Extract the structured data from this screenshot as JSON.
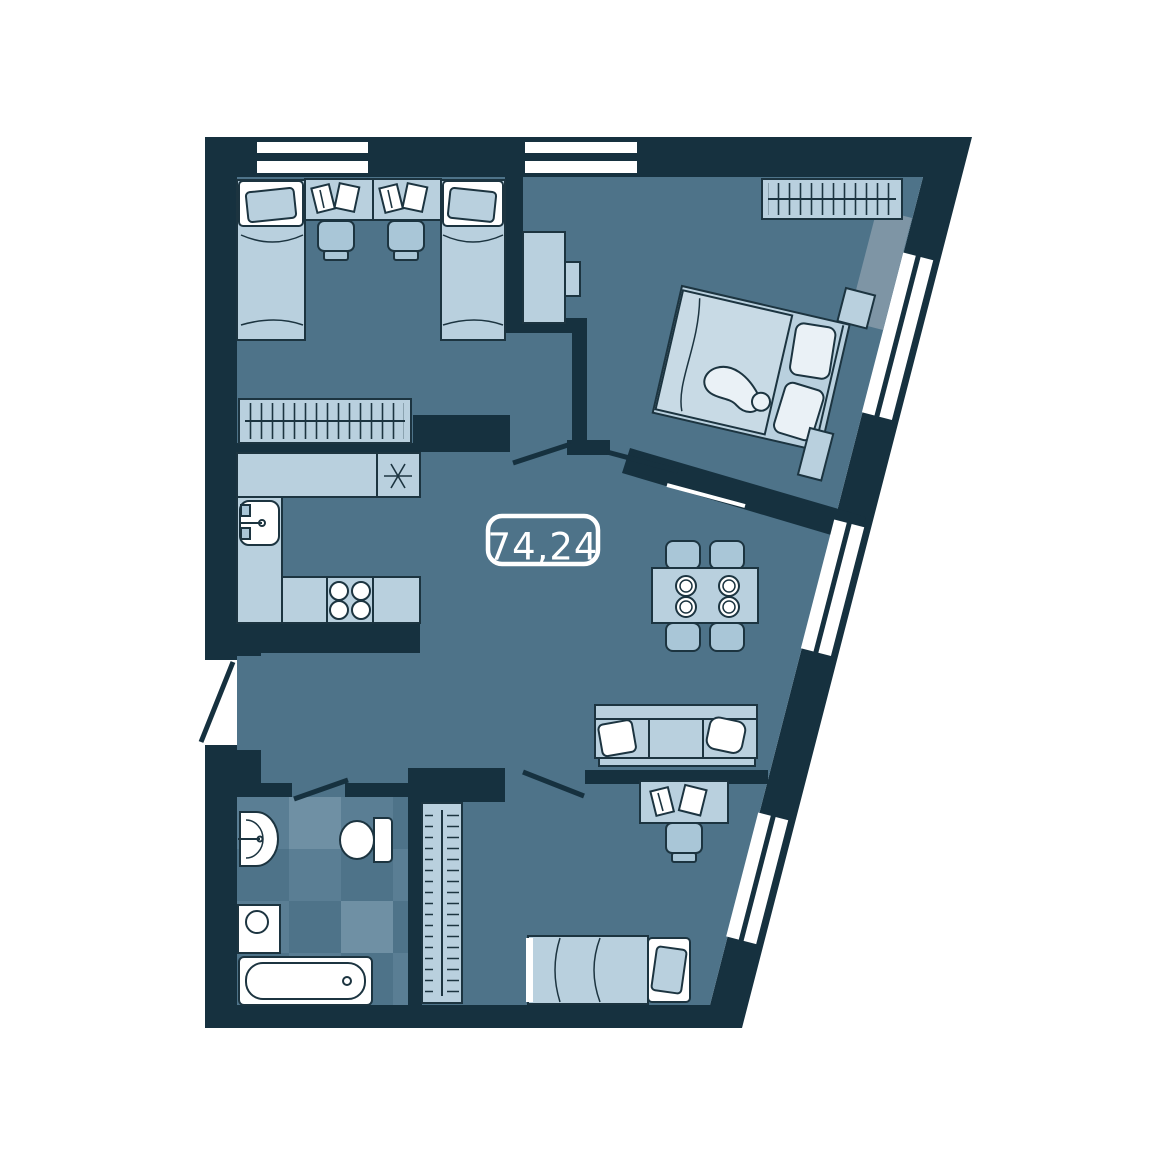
{
  "plan": {
    "area_label": "74,24",
    "type": "apartment-floor-plan",
    "rooms": [
      "kids-bedroom",
      "master-bedroom",
      "living-dining-room",
      "kitchen",
      "hallway",
      "bathroom",
      "small-bedroom"
    ],
    "icons": {
      "fridge": "snowflake-asterisk",
      "wardrobe": "hanger-rail-ticks",
      "stove": "four-burner-circles",
      "dining-plates": "double-ring-circles",
      "doors": "swing-leaf-line",
      "windows": "double-white-stripe"
    }
  },
  "colors": {
    "wall": "#16313F",
    "floor": "#4E7389",
    "furn": "#B9D0DE",
    "furnMid": "#A9C6D7",
    "furnLight": "#C8DAE5",
    "pillow": "#EAF1F6",
    "white": "#FFFFFF",
    "tile": "#5A7E94",
    "tileLight": "#6F90A4",
    "bay": "#7E95A5",
    "ink": "#1C3440"
  }
}
